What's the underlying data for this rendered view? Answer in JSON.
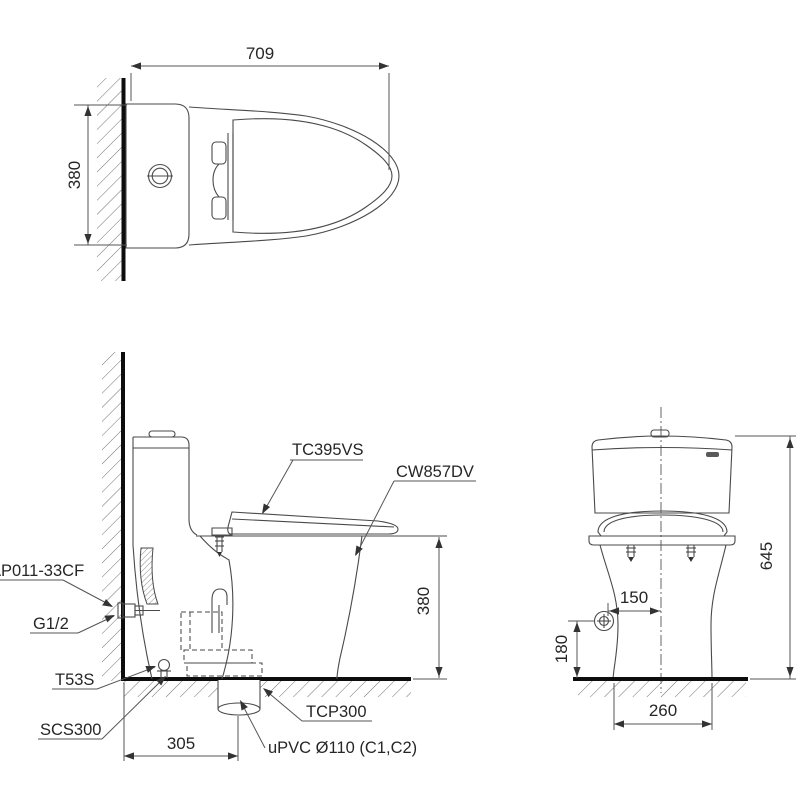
{
  "colors": {
    "background": "#ffffff",
    "line": "#4a4a4a",
    "heavy_line": "#0d0d0d",
    "text": "#262626"
  },
  "top_view": {
    "dim_width": "709",
    "dim_depth": "380"
  },
  "side_view": {
    "label_seat": "TC395VS",
    "label_bowl": "CW857DV",
    "label_hose": "AP011-33CF",
    "label_thread": "G1/2",
    "label_bolt": "T53S",
    "label_seal": "SCS300",
    "label_flange": "TCP300",
    "label_pipe": "uPVC Ø110 (C1,C2)",
    "dim_seat_height": "380",
    "dim_rough_in": "305"
  },
  "front_view": {
    "dim_total_height": "645",
    "dim_supply_offset": "150",
    "dim_supply_height": "180",
    "dim_base_width": "260"
  }
}
